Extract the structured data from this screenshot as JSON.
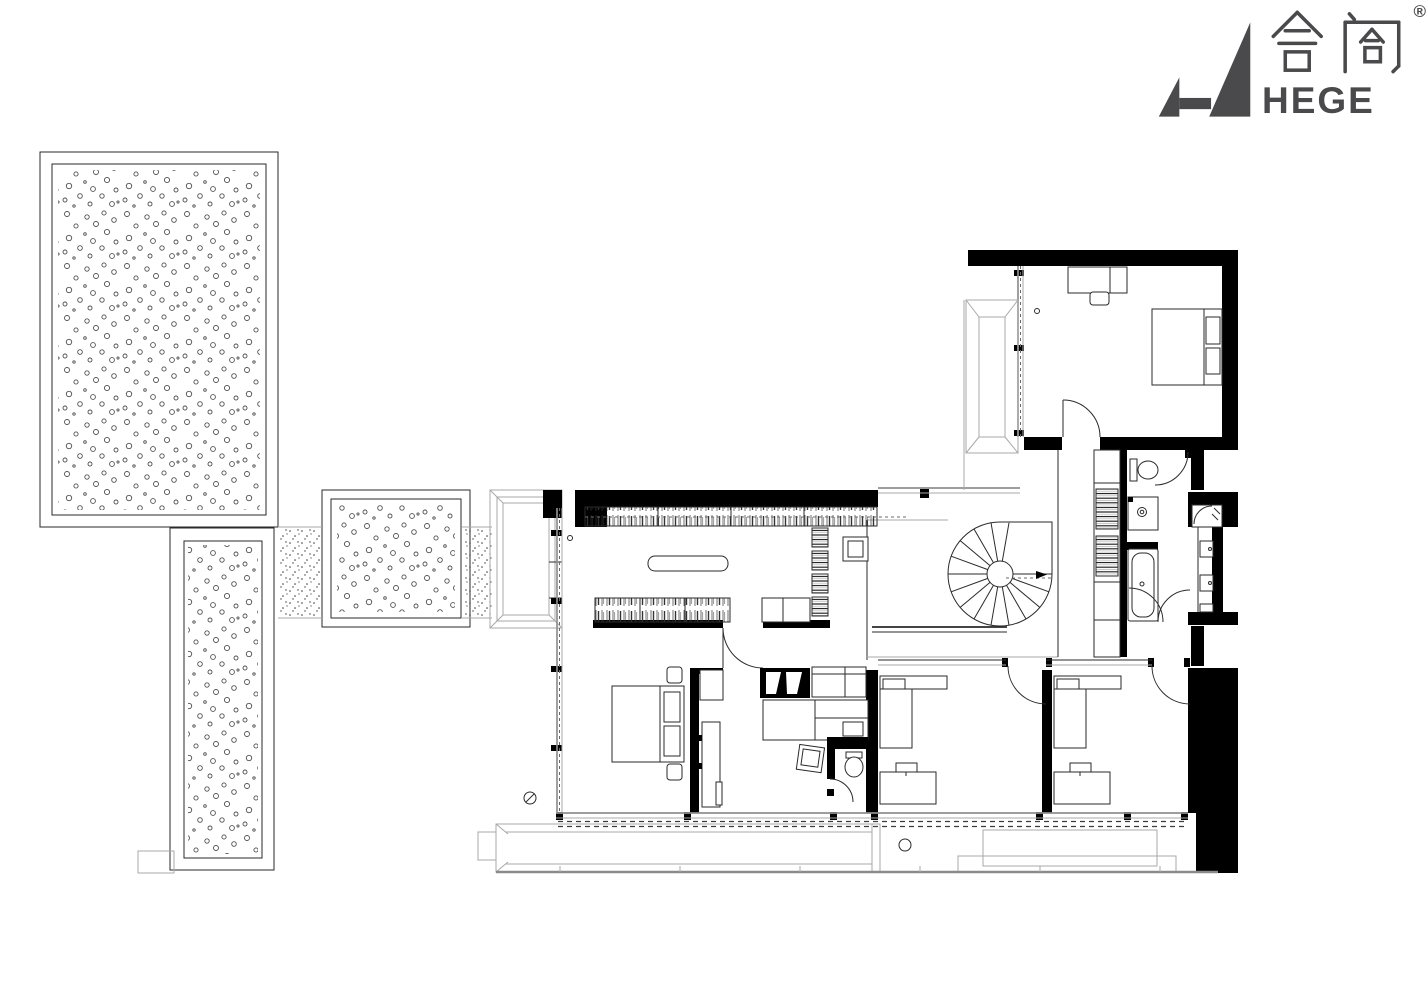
{
  "logo": {
    "brand_cn": "合阁",
    "brand_en": "HEGE",
    "registered_mark": "®",
    "color": "#4a4a4c"
  },
  "drawing": {
    "ink_color": "#2a2a2a",
    "wall_fill": "#000000",
    "secondary_line_color": "#8f8f8f",
    "paper_color": "#ffffff"
  }
}
